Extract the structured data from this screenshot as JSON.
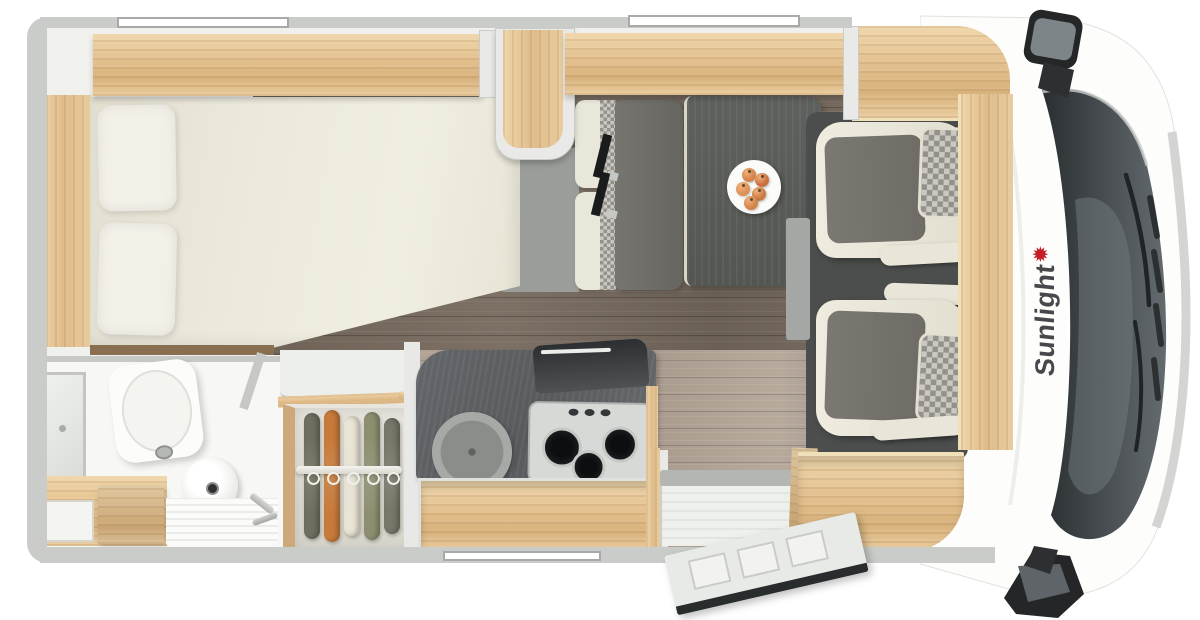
{
  "brand": {
    "name": "Sunlight",
    "star_icon": "✹",
    "text_color": "#46484b",
    "accent_red": "#c41f26"
  },
  "palette": {
    "wall_gray": "#c9ccc8",
    "interior_base": "#f0f0ed",
    "wood": "#e3c191",
    "floor_dark": "#746a5f",
    "floor_light": "#b3a79a",
    "cab_mat": "#4b4e4c",
    "seat_cream": "#e6e3d6",
    "seat_gray": "#787570",
    "bench_cushion": "#6e6d67",
    "table": "#585c59",
    "counter": "#5e6163",
    "windshield": "#2f3336",
    "body_white": "#fdfdfc",
    "mattress": "#ece9dc"
  },
  "wardrobe": {
    "clothes_colors": [
      "#6f6f60",
      "#c87a3a",
      "#e9e5d5",
      "#8d9070",
      "#77776a"
    ],
    "clothes_heights": [
      126,
      132,
      120,
      128,
      116
    ]
  },
  "plate": {
    "fruit_colors": [
      "#d4824a",
      "#c96f3d",
      "#dd9055",
      "#c97a40",
      "#d28348"
    ],
    "fruit_positions": [
      [
        15,
        8
      ],
      [
        28,
        13
      ],
      [
        9,
        22
      ],
      [
        25,
        27
      ],
      [
        17,
        36
      ]
    ]
  }
}
